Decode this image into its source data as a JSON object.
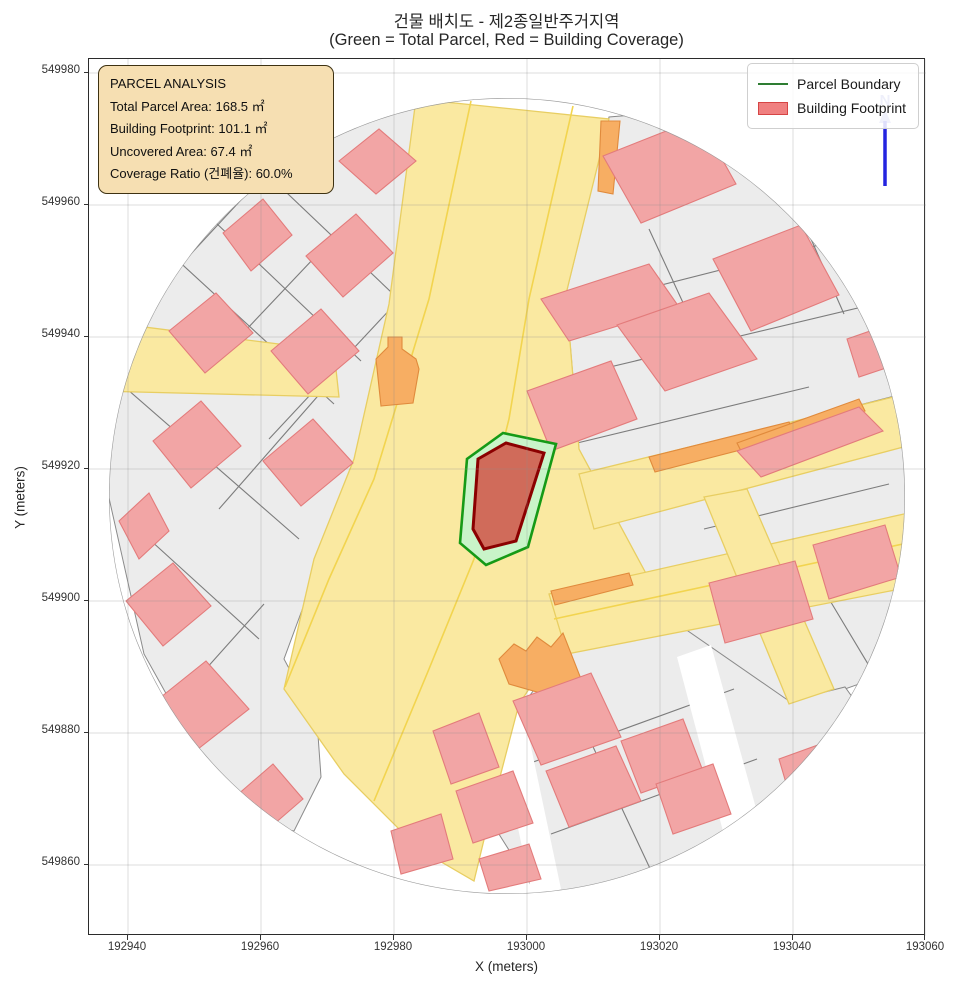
{
  "title": {
    "line1": "건물 배치도 - 제2종일반주거지역",
    "line2": "(Green = Total Parcel, Red = Building Coverage)"
  },
  "axes": {
    "xlabel": "X (meters)",
    "ylabel": "Y (meters)",
    "x_ticks": [
      "192940",
      "192960",
      "192980",
      "193000",
      "193020",
      "193040",
      "193060"
    ],
    "y_ticks": [
      "549980",
      "549960",
      "549940",
      "549920",
      "549900",
      "549880",
      "549860"
    ]
  },
  "legend": {
    "items": [
      {
        "label": "Parcel Boundary",
        "type": "line",
        "color": "#2e7d32"
      },
      {
        "label": "Building Footprint",
        "type": "patch",
        "color": "#F08080"
      }
    ]
  },
  "analysis_box": {
    "title": "PARCEL ANALYSIS",
    "lines": [
      "Total Parcel Area: 168.5 ㎡",
      "Building Footprint: 101.1 ㎡",
      "Uncovered Area: 67.4 ㎡",
      "Coverage Ratio (건폐율): 60.0%"
    ]
  },
  "north_arrow": {
    "label": "N"
  },
  "colors": {
    "road_fill": "#FAE9A1",
    "road_edge": "#E8CE62",
    "building_pink": "#F2A5A5",
    "building_orange": "#F7AE63",
    "parcel_gray": "#ECECEC",
    "highlight_parcel_fill": "#C9F4C9",
    "highlight_parcel_edge": "#169A16",
    "highlight_building_fill": "#D06B5A",
    "highlight_building_edge": "#8B0000",
    "north_arrow_blue": "#2424E0"
  },
  "chart_data": {
    "type": "map",
    "title": "건물 배치도 - 제2종일반주거지역",
    "subtitle": "(Green = Total Parcel, Red = Building Coverage)",
    "xlabel": "X (meters)",
    "ylabel": "Y (meters)",
    "xlim": [
      192934,
      193060
    ],
    "ylim": [
      549849,
      549982
    ],
    "zoning": "제2종일반주거지역",
    "total_parcel_area_m2": 168.5,
    "building_footprint_m2": 101.1,
    "uncovered_area_m2": 67.4,
    "coverage_ratio_pct": 60.0,
    "parcel_center_approx": [
      192997,
      549916
    ],
    "clip_buffer_radius_m": 60,
    "grid": true,
    "legend_position": "upper right"
  }
}
